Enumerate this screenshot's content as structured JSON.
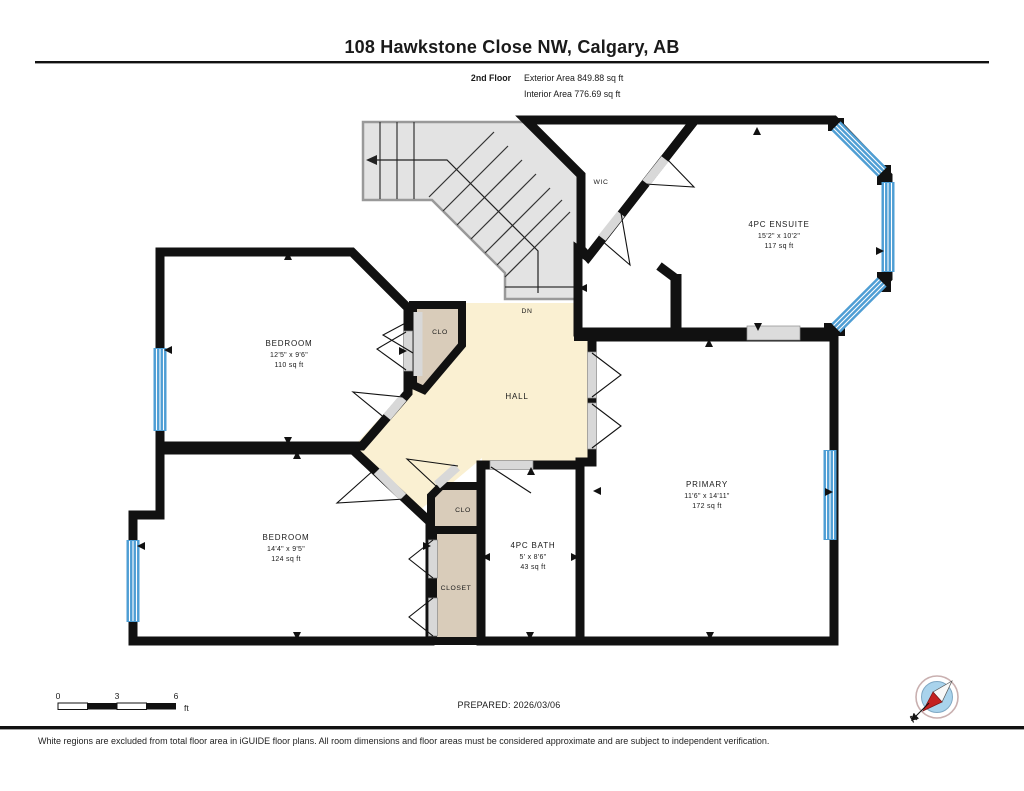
{
  "header": {
    "title": "108 Hawkstone Close NW, Calgary, AB",
    "floor_label": "2nd Floor",
    "exterior_area": "Exterior Area 849.88 sq ft",
    "interior_area": "Interior Area 776.69 sq ft"
  },
  "rooms": {
    "bedroom1": {
      "name": "BEDROOM",
      "dims": "12'5\" x 9'6\"",
      "area": "110 sq ft"
    },
    "bedroom2": {
      "name": "BEDROOM",
      "dims": "14'4\" x 9'5\"",
      "area": "124 sq ft"
    },
    "bath": {
      "name": "4PC BATH",
      "dims": "5' x 8'6\"",
      "area": "43 sq ft"
    },
    "primary": {
      "name": "PRIMARY",
      "dims": "11'6\" x 14'11\"",
      "area": "172 sq ft"
    },
    "ensuite": {
      "name": "4PC ENSUITE",
      "dims": "15'2\" x 10'2\"",
      "area": "117 sq ft"
    },
    "wic": {
      "name": "WIC"
    },
    "hall": {
      "name": "HALL"
    },
    "clo": {
      "name": "CLO"
    },
    "closet": {
      "name": "CLOSET"
    },
    "stairs": {
      "down_label": "DN"
    }
  },
  "scale_bar": {
    "tick0": "0",
    "tick1": "3",
    "tick2": "6",
    "unit": "ft"
  },
  "prepared_label": "PREPARED: 2026/03/06",
  "compass": {
    "north_label": "N"
  },
  "footer": {
    "disclaimer": "White regions are excluded from total floor area in iGUIDE floor plans. All room dimensions and floor areas must be considered approximate and are subject to independent verification."
  },
  "colors": {
    "room_fill": "#FAF0D2",
    "wet_fill": "#C5E4F8",
    "closet_fill": "#D9CCBA",
    "stair_fill": "#E3E3E3",
    "wall": "#111111",
    "window_blue": "#4E9ED4",
    "door_gray": "#D8D8D8",
    "compass_red": "#C42121"
  }
}
